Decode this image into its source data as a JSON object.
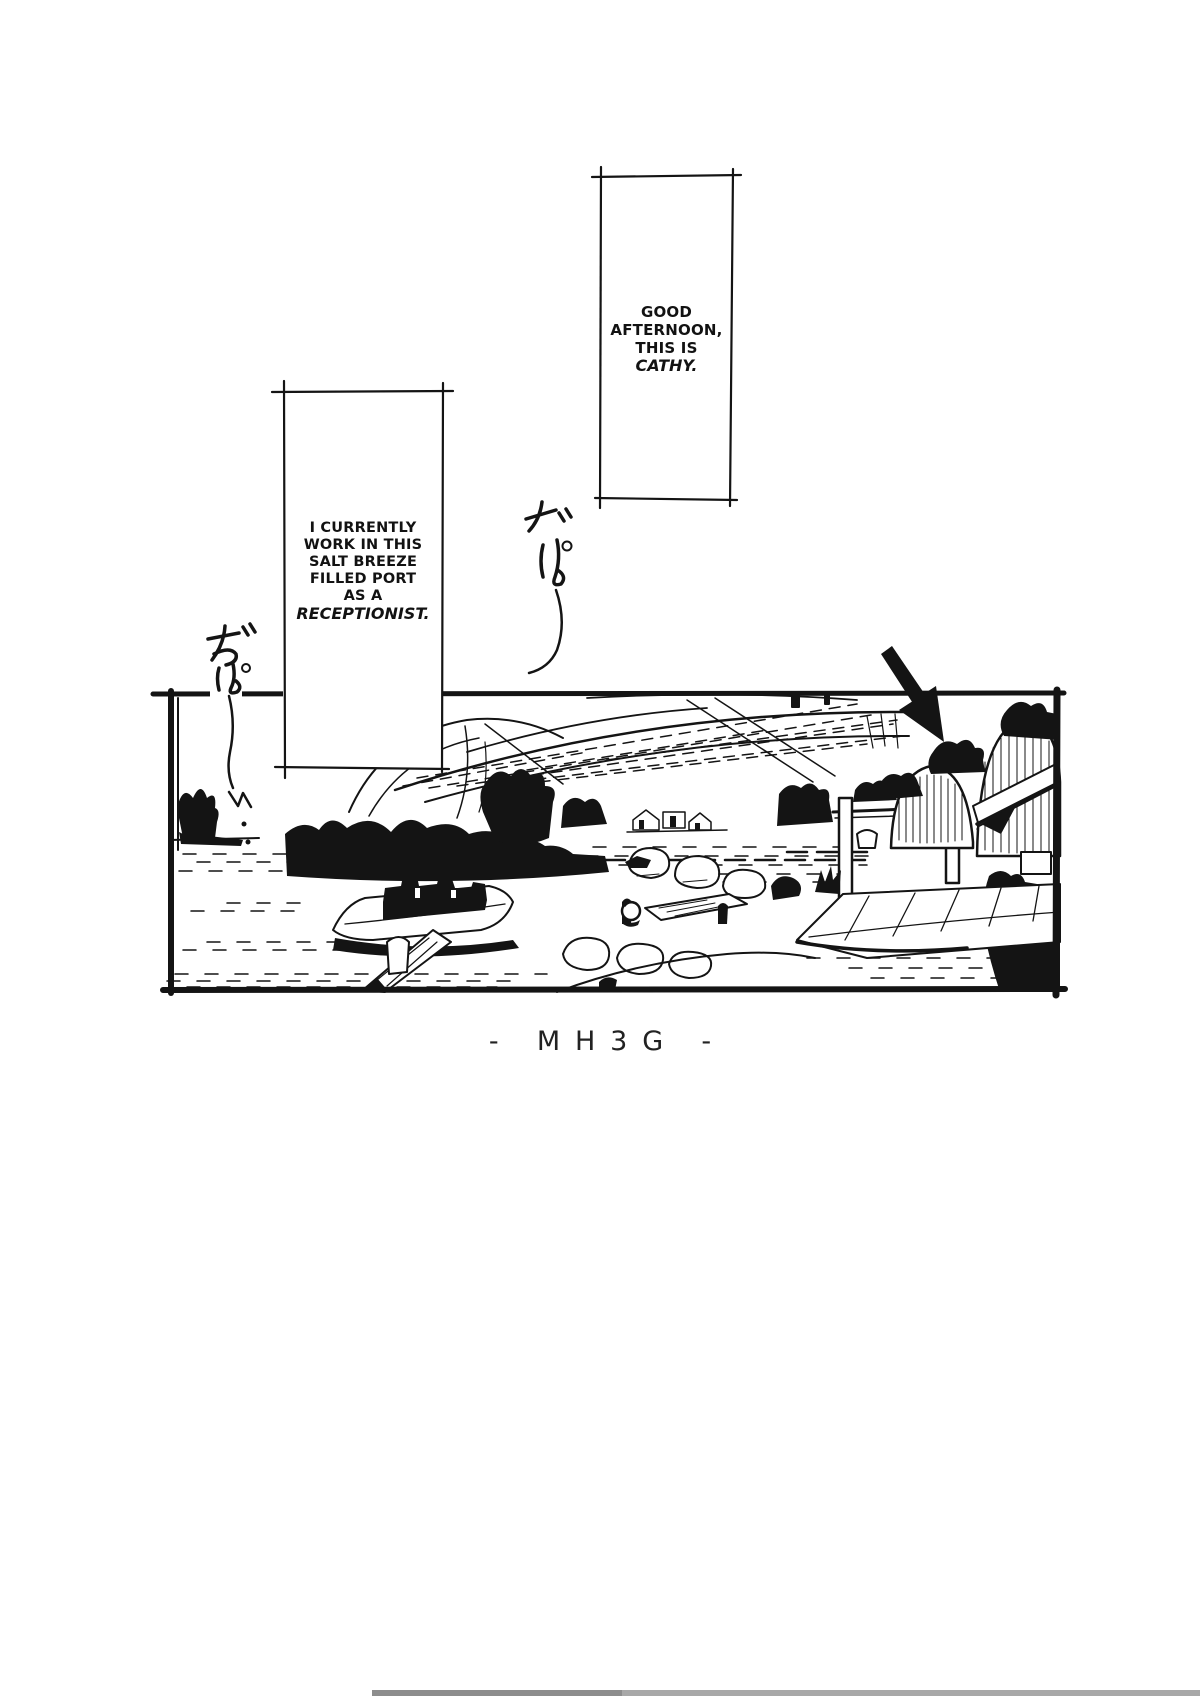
{
  "page": {
    "type": "manga page",
    "paper_color": "#ffffff",
    "ink_color": "#141414",
    "caption": {
      "text": "- MH3G -"
    }
  },
  "bubbles": {
    "greeting": {
      "full_text": "GOOD AFTERNOON, THIS IS CATHY.",
      "lines": [
        "GOOD",
        "AFTERNOON,",
        "THIS IS"
      ],
      "emphasis": "CATHY."
    },
    "narration": {
      "full_text": "I CURRENTLY WORK IN THIS SALT BREEZE FILLED PORT AS A RECEPTIONIST.",
      "lines": [
        "I CURRENTLY",
        "WORK IN THIS",
        "SALT BREEZE",
        "FILLED PORT",
        "AS A"
      ],
      "emphasis": "RECEPTIONIST."
    }
  },
  "sfx": [
    {
      "text": "ざぱ",
      "romaji": "zapa"
    },
    {
      "text": "ざぱ",
      "romaji": "zapa"
    }
  ],
  "panel": {
    "alt": "Hand-drawn harbor port scene: boats on calm water, rocks and a small pier, a plank ramp leading up to gated arched port buildings; a bold black arrow points at the reception building."
  }
}
